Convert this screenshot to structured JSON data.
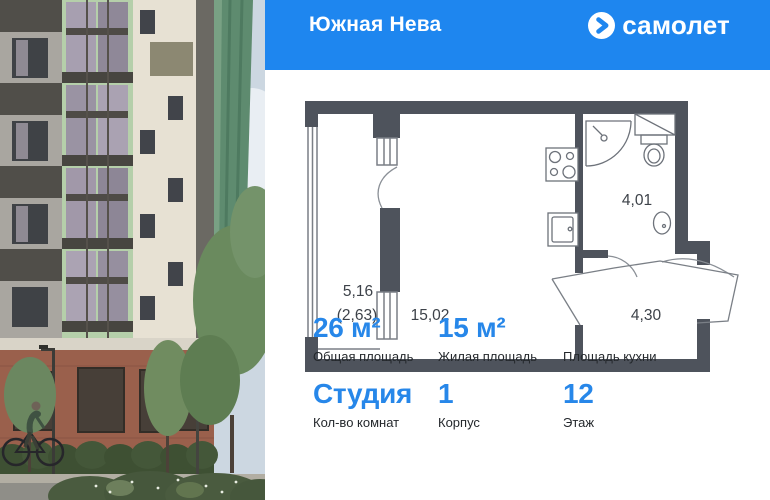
{
  "colors": {
    "header_bg": "#1e86ef",
    "accent_blue": "#2787e9",
    "label_text": "#24282c",
    "plan_wall": "#4e535c"
  },
  "header": {
    "project_title": "Южная Нева",
    "brand_name": "самолет"
  },
  "floor_plan": {
    "balcony_area": "5,16",
    "balcony_area_reduced": "(2,63)",
    "living_area": "15,02",
    "bathroom_area": "4,01",
    "hallway_area": "4,30"
  },
  "stats": {
    "row1": [
      {
        "value": "26 м²",
        "label": "Общая площадь"
      },
      {
        "value": "15 м²",
        "label": "Жилая площадь"
      },
      {
        "value": "",
        "label": "Площадь кухни"
      }
    ],
    "row2": [
      {
        "value": "Студия",
        "label": "Кол-во комнат"
      },
      {
        "value": "1",
        "label": "Корпус"
      },
      {
        "value": "12",
        "label": "Этаж"
      }
    ]
  }
}
